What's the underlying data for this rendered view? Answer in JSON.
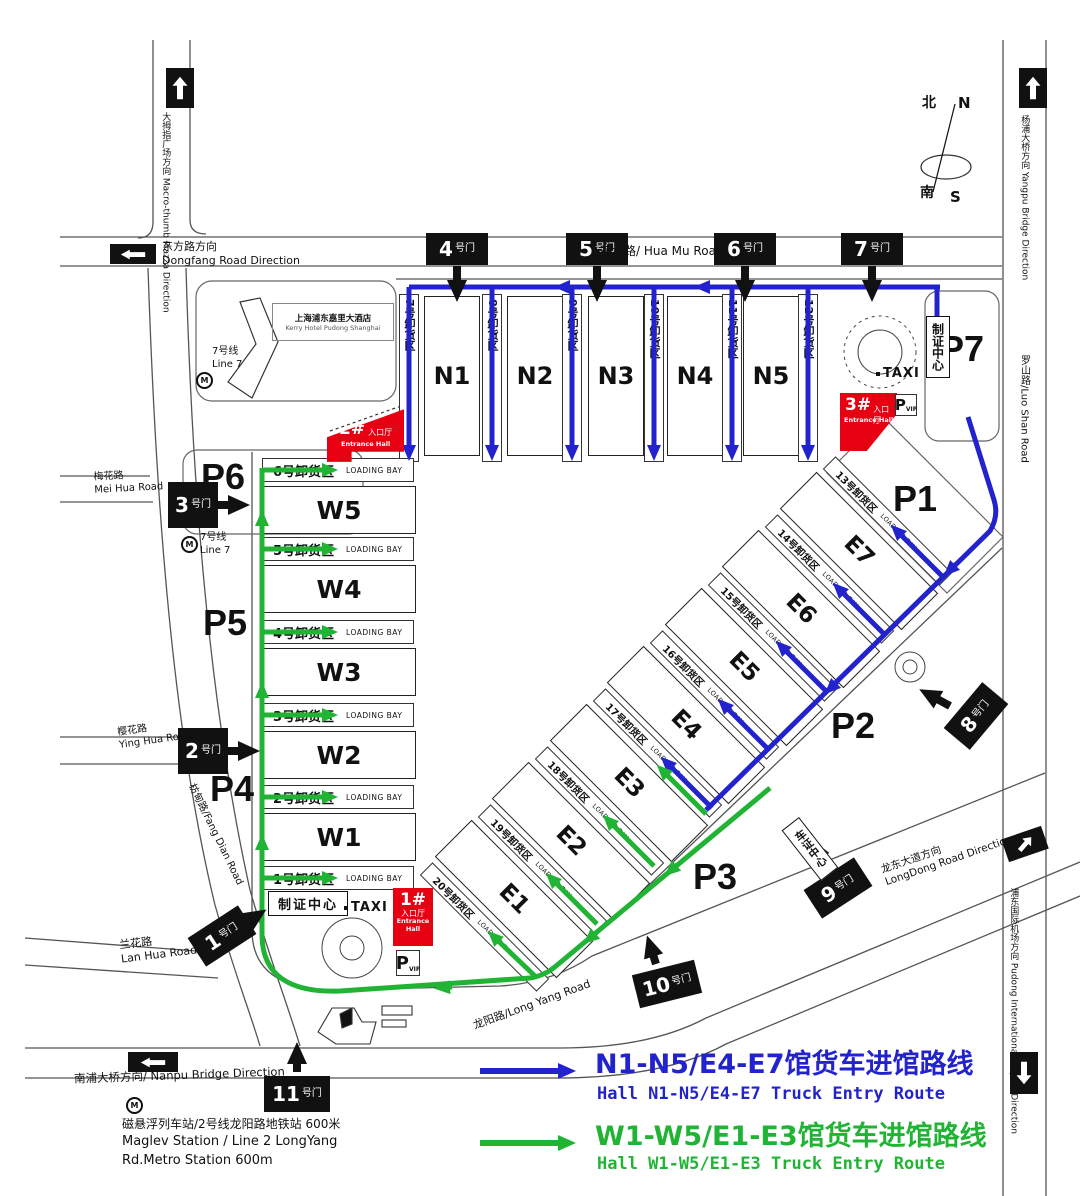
{
  "legend": {
    "items": [
      {
        "zh": "N1-N5/E4-E7馆货车进馆路线",
        "en": "Hall N1-N5/E4-E7 Truck Entry Route",
        "color": "#2323cd"
      },
      {
        "zh": "W1-W5/E1-E3馆货车进馆路线",
        "en": "Hall W1-W5/E1-E3 Truck Entry Route",
        "color": "#21b434"
      }
    ]
  },
  "compass": {
    "n_zh": "北",
    "n_en": "N",
    "s_zh": "南",
    "s_en": "S"
  },
  "roads": {
    "macro_thumb_zh": "大拇指广场方向",
    "macro_thumb_en": "Macro-thumb Piazza Direction",
    "dongfang_zh": "东方路方向",
    "dongfang_en": "Dongfang Road Direction",
    "huamu": "花木路/ Hua Mu Road",
    "yangpu_zh": "杨浦大桥方向",
    "yangpu_en": "Yangpu Bridge Direction",
    "luoshan": "罗山路/Luo Shan Road",
    "meihua_zh": "梅花路",
    "meihua_en": "Mei Hua Road",
    "yinghua_zh": "樱花路",
    "yinghua_en": "Ying Hua Road",
    "fangdian": "枋甸路/Fang Dian Road",
    "lanhua_zh": "兰花路",
    "lanhua_en": "Lan Hua Road",
    "nanpu": "南浦大桥方向/ Nanpu Bridge Direction",
    "longyang": "龙阳路/Long Yang Road",
    "longdong_zh": "龙东大道方向",
    "longdong_en": "LongDong Road Direction",
    "pudong_zh": "浦东国际机场方向",
    "pudong_en": "Pudong International Airport Direction"
  },
  "gate_suffix": "号门",
  "gates": [
    "1",
    "2",
    "3",
    "4",
    "5",
    "6",
    "7",
    "8",
    "9",
    "10",
    "11"
  ],
  "halls": {
    "north": [
      "N1",
      "N2",
      "N3",
      "N4",
      "N5"
    ],
    "west": [
      "W1",
      "W2",
      "W3",
      "W4",
      "W5"
    ],
    "east": [
      "E1",
      "E2",
      "E3",
      "E4",
      "E5",
      "E6",
      "E7"
    ]
  },
  "bays": {
    "en": "LOADING BAY",
    "north": [
      "7号卸货区",
      "8号卸货区",
      "9号卸货区",
      "10号卸货区",
      "11号卸货区",
      "12号卸货区"
    ],
    "west": [
      "1号卸货区",
      "2号卸货区",
      "3号卸货区",
      "4号卸货区",
      "5号卸货区",
      "6号卸货区"
    ],
    "east": [
      "13号卸货区",
      "14号卸货区",
      "15号卸货区",
      "16号卸货区",
      "17号卸货区",
      "18号卸货区",
      "19号卸货区",
      "20号卸货区"
    ]
  },
  "parking": [
    "P1",
    "P2",
    "P3",
    "P4",
    "P5",
    "P6",
    "P7"
  ],
  "entrances": [
    {
      "num": "1#",
      "hall_zh": "入口厅",
      "hall_en": "Entrance Hall"
    },
    {
      "num": "2#",
      "hall_zh": "入口厅",
      "hall_en": "Entrance Hall"
    },
    {
      "num": "3#",
      "hall_zh": "入口厅",
      "hall_en": "Entrance Hall"
    }
  ],
  "facilities": {
    "cert_center": "制证中心",
    "vehicle_cert_center": "车证中心",
    "taxi": "TAXI",
    "p": "P",
    "vip": "VIP",
    "line7_zh": "7号线",
    "line7_en": "Line 7",
    "metro_m": "M",
    "hotel_zh": "上海浦东嘉里大酒店",
    "hotel_en": "Kerry Hotel Pudong Shanghai",
    "maglev_zh": "磁悬浮列车站/2号线龙阳路地铁站  600米",
    "maglev_en1": "Maglev Station / Line 2 LongYang",
    "maglev_en2": "Rd.Metro Station 600m"
  },
  "colors": {
    "route_blue": "#2323cd",
    "route_green": "#21b434",
    "entrance_red": "#e60012",
    "gate_black": "#111111"
  }
}
